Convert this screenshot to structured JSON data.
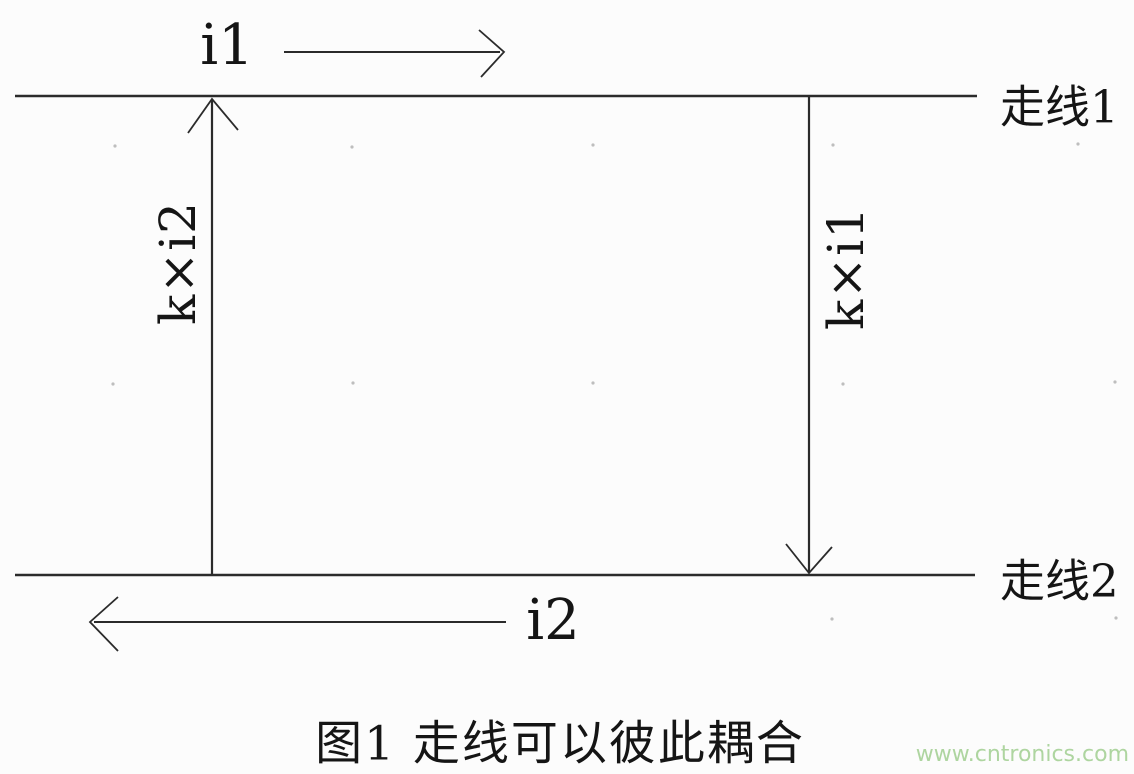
{
  "figure": {
    "trace1": {
      "label": "走线1"
    },
    "trace2": {
      "label": "走线2"
    },
    "current1": {
      "label": "i1"
    },
    "current2": {
      "label": "i2"
    },
    "coupling_left": {
      "label": "k×i2"
    },
    "coupling_right": {
      "label": "k×i1"
    },
    "caption": "图1 走线可以彼此耦合",
    "watermark": "www.cntronics.com",
    "colors": {
      "line": "#2b2b2b",
      "text": "#151515",
      "watermark": "#aed5a0",
      "background": "#fcfcfc"
    }
  }
}
